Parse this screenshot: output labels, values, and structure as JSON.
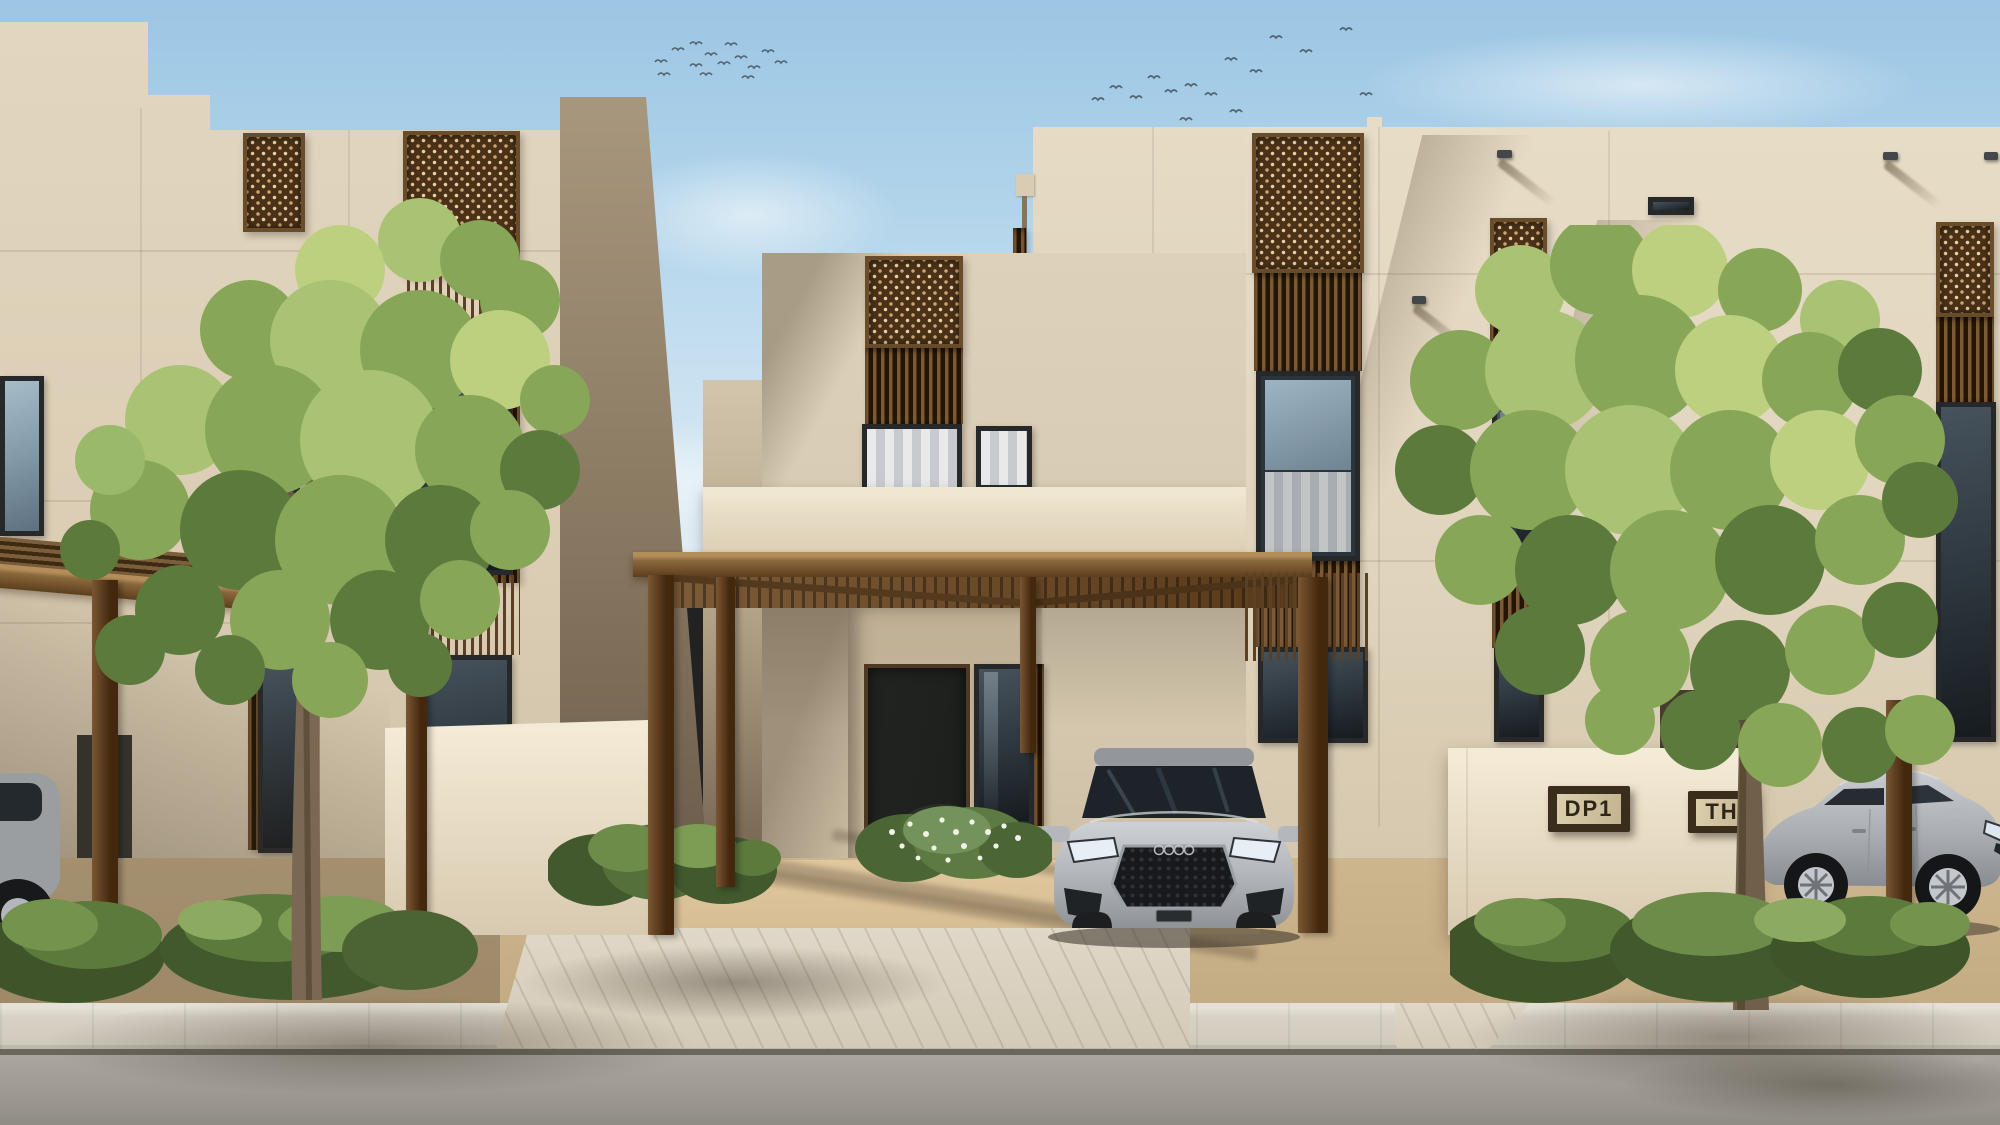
{
  "scene": {
    "signs": {
      "unit_plaque": "DP1",
      "block_plaque": "TH"
    },
    "palette": {
      "sky_top": "#9cc6e4",
      "sky_horizon": "#dfecf4",
      "facade_light": "#e4d9c3",
      "facade_center": "#d7cab2",
      "facade_shadow": "#8a7a64",
      "lattice_wood": "#54381f",
      "pergola_wood": "#8a693f",
      "door": "#1f211f",
      "window_glass": "#39444d",
      "foliage_light": "#a9c273",
      "foliage_mid": "#87a657",
      "foliage_dark": "#5d7a3d",
      "car_silver": "#b6babe",
      "ground_sand": "#d3bb93",
      "paver": "#dcd4c4",
      "road": "#a39e98"
    },
    "environment": {
      "bird_flocks": 2,
      "parked_cars": 3,
      "street_trees": 2
    }
  }
}
